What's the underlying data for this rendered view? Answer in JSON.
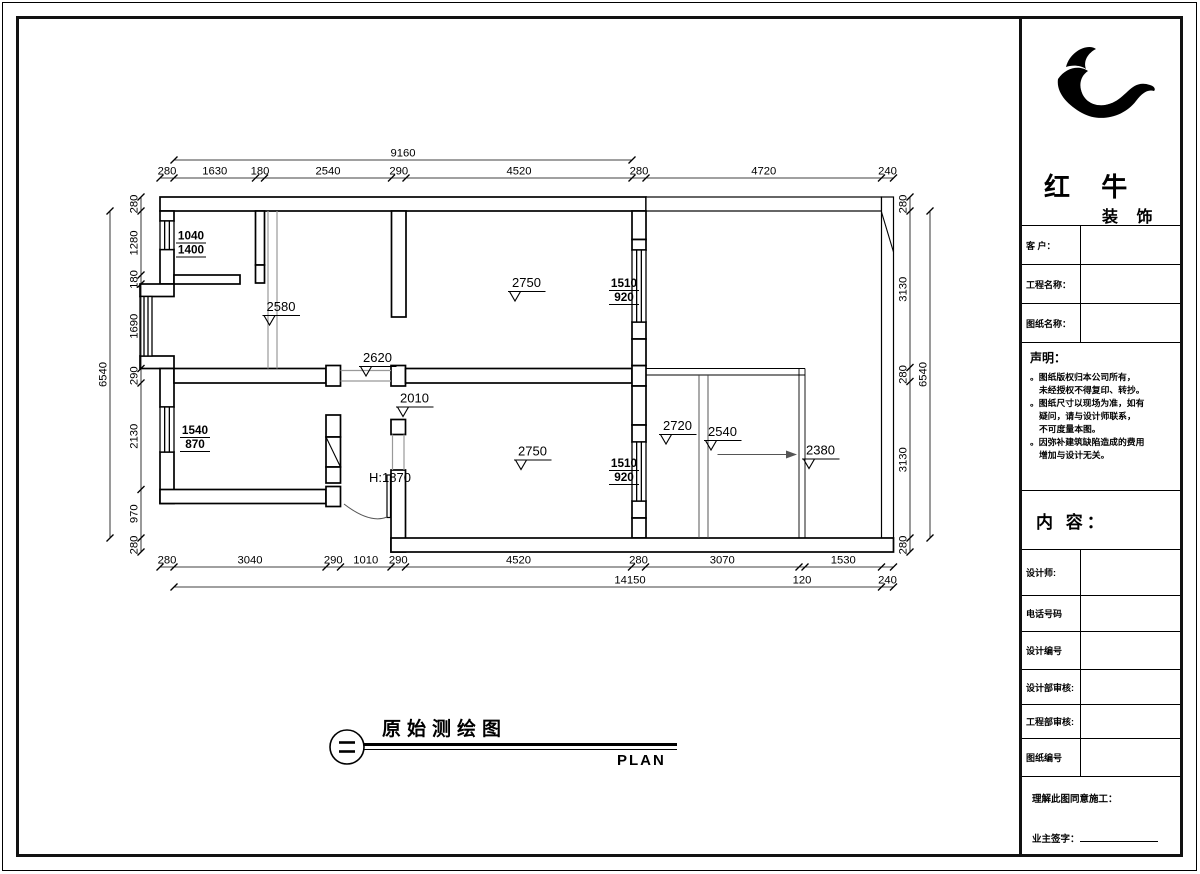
{
  "title_block": {
    "brand": "红 牛",
    "brand_sub": "装 饰",
    "customer_label": "客 户：",
    "project_label": "工程名称：",
    "drawing_label": "图纸名称：",
    "declaration_title": "声明：",
    "declaration_lines": [
      "。图纸版权归本公司所有，",
      "未经授权不得复印、转抄。",
      "。图纸尺寸以现场为准，如有",
      "疑问，请与设计师联系，",
      "不可度量本图。",
      "。因弥补建筑缺陷造成的费用",
      "增加与设计无关。"
    ],
    "content_label": "内 容：",
    "designer_label": "设计师:",
    "phone_label": "电话号码",
    "design_no_label": "设计编号",
    "design_audit_label": "设计部审核:",
    "eng_audit_label": "工程部审核:",
    "drawing_no_label": "图纸编号",
    "consent_text": "理解此图同意施工：",
    "owner_sign_label": "业主签字："
  },
  "footer": {
    "title": "原始测绘图",
    "plan_label": "PLAN"
  },
  "plan": {
    "dims": {
      "top_overall": "9160",
      "top": [
        "280",
        "1630",
        "180",
        "2540",
        "290",
        "4520",
        "280",
        "4720",
        "240"
      ],
      "left_overall": "6540",
      "left": [
        "280",
        "1280",
        "180",
        "1690",
        "290",
        "2130",
        "970",
        "280"
      ],
      "right": [
        "280",
        "3130",
        "280",
        "3130",
        "280"
      ],
      "right_overall": "6540",
      "bottom": [
        "280",
        "3040",
        "290",
        "1010",
        "290",
        "4520",
        "280",
        "3070",
        "1530"
      ],
      "bottom_overall": "14150",
      "bottom_extra": [
        "120",
        "240"
      ]
    },
    "heights": [
      "2580",
      "2750",
      "2620",
      "2010",
      "2750",
      "2720",
      "2540",
      "2380"
    ],
    "door_height": "H:1870",
    "windows": [
      [
        "1040",
        "1400"
      ],
      [
        "1540",
        "870"
      ],
      [
        "1510",
        "920"
      ],
      [
        "1510",
        "920"
      ]
    ]
  }
}
